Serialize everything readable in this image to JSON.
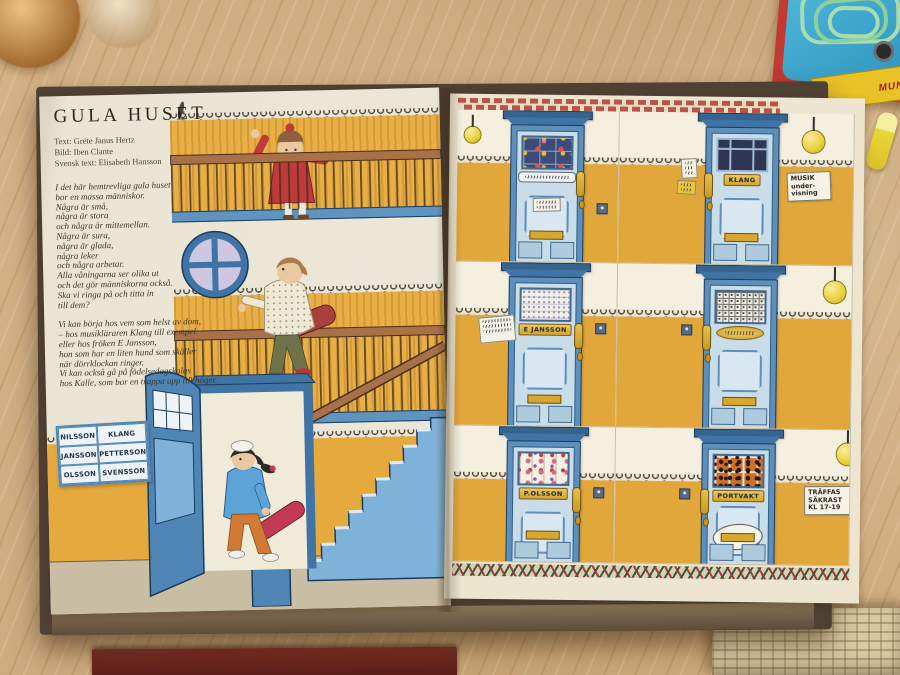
{
  "book": {
    "left_page": {
      "title": "GULA HUSET",
      "credits": [
        "Text: Grete Janus Hertz",
        "Bild: Iben Clante",
        "Svensk text: Elisabeth Hansson"
      ],
      "poem_stanza1": [
        "I det här hemtrevliga gula huset",
        "bor en massa människor.",
        "Några är små,",
        "några är stora",
        "och några är mittemellan.",
        "Några är sura,",
        "några är glada,",
        "några leker",
        "och några arbetar.",
        "Alla våningarna ser olika ut",
        "och det gör människorna också.",
        "Ska vi ringa på och titta in",
        "till dem?"
      ],
      "poem_stanza2": [
        "Vi kan börja hos vem som helst av dom,",
        "– hos musikläraren Klang till exempel",
        "eller hos fröken E Jansson,",
        "hon som har en liten hund som skäller",
        "när dörrklockan ringer.",
        "Vi kan också gå på födelsedagskalas",
        "hos Kalle, som bor en trappa upp till höger."
      ],
      "name_board": {
        "rows": [
          [
            "NILSSON",
            "KLANG"
          ],
          [
            "JANSSON",
            "PETTERSON"
          ],
          [
            "OLSSON",
            "SVENSSON"
          ]
        ]
      }
    },
    "right_page": {
      "doors": [
        {
          "cell": "top-left",
          "window_pattern": "children-drawings",
          "nameplate": ""
        },
        {
          "cell": "top-right",
          "window_pattern": "dark-panes",
          "nameplate": "KLANG",
          "side_note_lines": [
            "MUSIK",
            "under-",
            "visning"
          ]
        },
        {
          "cell": "middle-left",
          "window_pattern": "lace-curtain",
          "nameplate": "E JANSSON"
        },
        {
          "cell": "middle-right",
          "window_pattern": "lattice",
          "nameplate": ""
        },
        {
          "cell": "bottom-left",
          "window_pattern": "floral-stained-glass",
          "nameplate": "P.OLSSON"
        },
        {
          "cell": "bottom-right",
          "window_pattern": "leopard-curtain",
          "nameplate": "PORTVAKT",
          "oval_plate_text": "Svensson",
          "side_note_lines": [
            "TRÄFFAS",
            "SÄKRAST",
            "KL 17-19"
          ]
        }
      ]
    }
  },
  "surroundings": {
    "toy_label_lines": [
      "MOBI",
      "MUNICATIO"
    ]
  },
  "colors": {
    "wall_yellow": "#e2a73b",
    "door_frame_blue": "#5d8fba",
    "door_leaf_blue": "#c9dde9",
    "brass": "#d9a72e",
    "paper_cream": "#ede5cf",
    "wood_table": "#cfad7e"
  }
}
